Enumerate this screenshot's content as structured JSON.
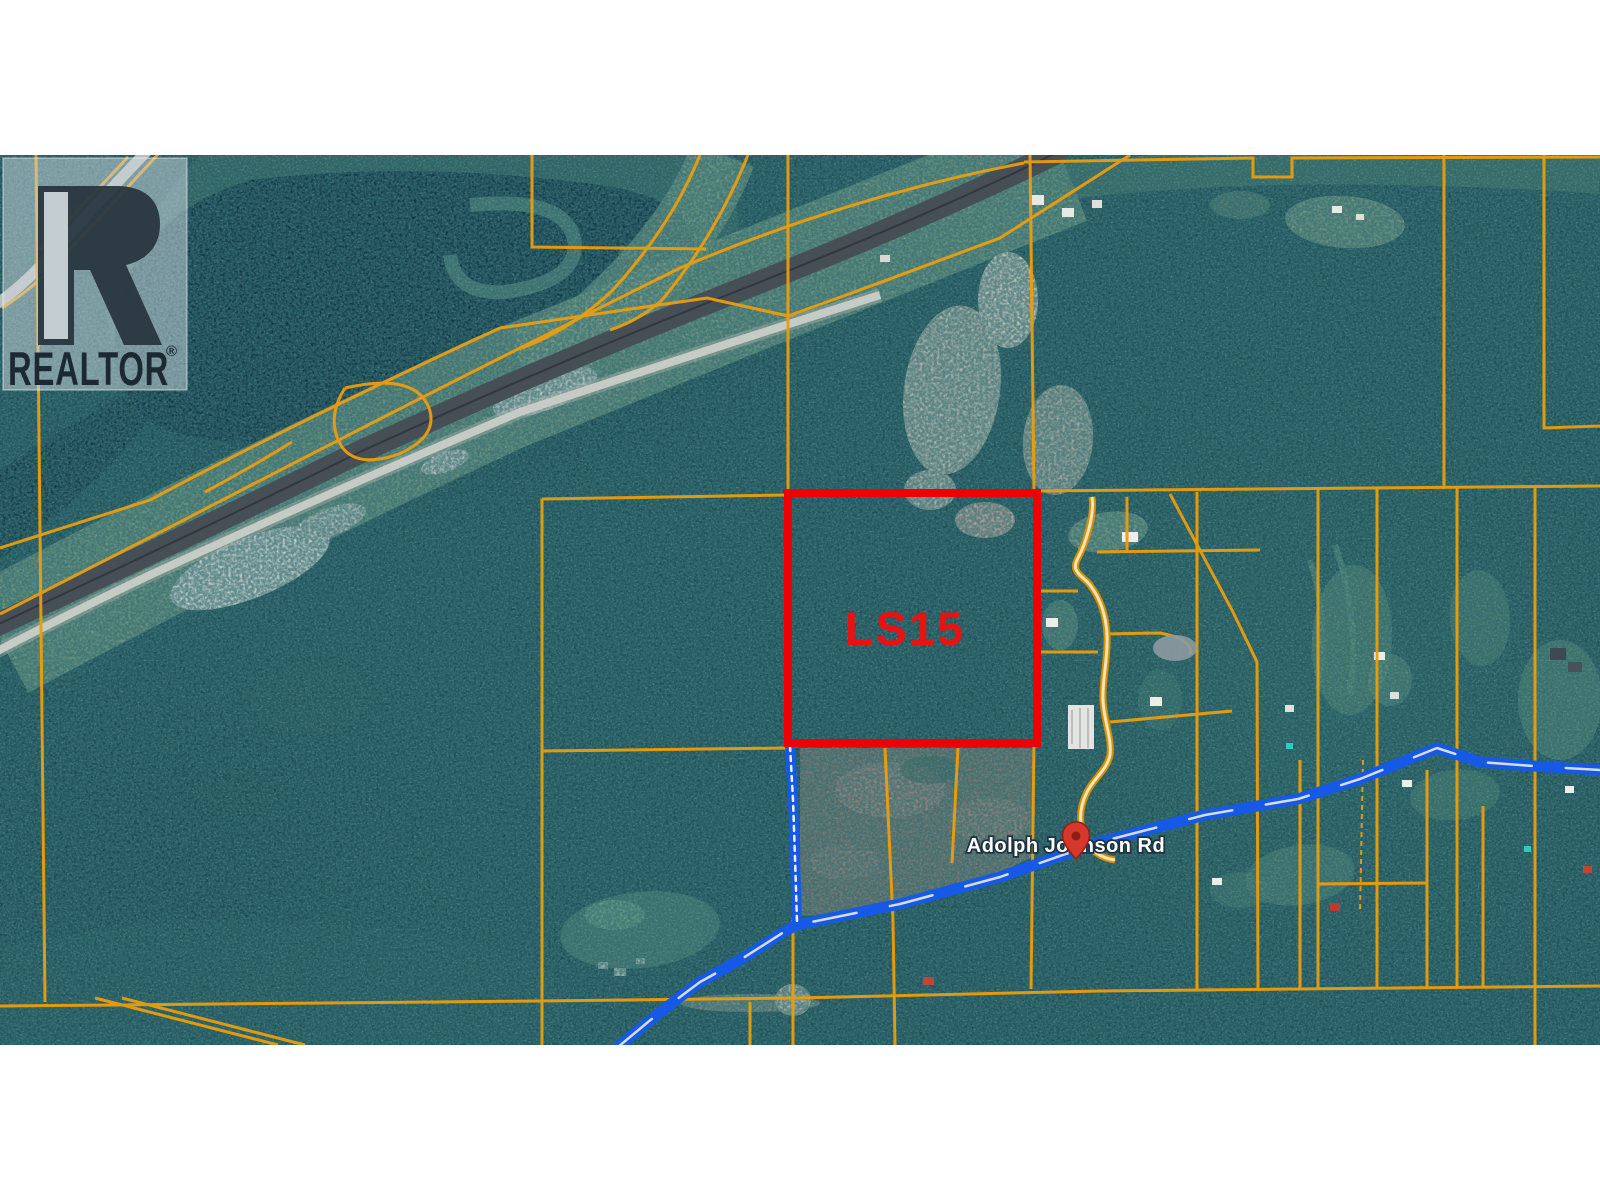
{
  "watermark": {
    "brand": "REALTOR",
    "registered_mark": "®"
  },
  "map": {
    "highlighted_parcel_label": "LS15",
    "road_label": "Adolph Johnson Rd"
  },
  "colors": {
    "highlight_red": "#ee0005",
    "label_red": "#e81212",
    "parcel_line_orange": "#ec9e0c",
    "road_overlay_blue": "#1659e6",
    "road_label_white": "#ffffff",
    "letterbox_white": "#ffffff",
    "forest_teal": "#1e4c52"
  }
}
